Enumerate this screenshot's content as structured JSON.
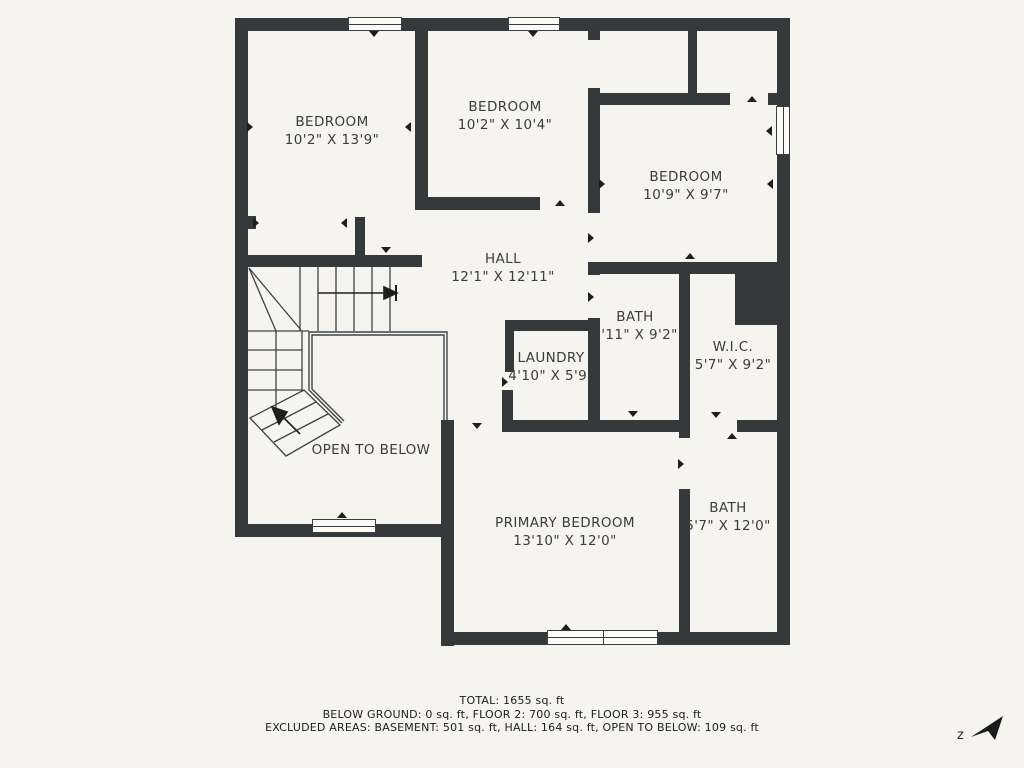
{
  "floorplan": {
    "colors": {
      "background": "#f5f4ee",
      "wall": "#35393c",
      "ink": "#1e1e1e",
      "line": "#3f4346",
      "text": "#3c3c3c"
    },
    "rooms": [
      {
        "id": "bedroom-1",
        "name": "BEDROOM",
        "dims": "10'2\" X 13'9\"",
        "cx": 332,
        "cy": 113
      },
      {
        "id": "bedroom-2",
        "name": "BEDROOM",
        "dims": "10'2\" X 10'4\"",
        "cx": 505,
        "cy": 98
      },
      {
        "id": "bedroom-3",
        "name": "BEDROOM",
        "dims": "10'9\" X 9'7\"",
        "cx": 686,
        "cy": 168
      },
      {
        "id": "hall",
        "name": "HALL",
        "dims": "12'1\" X 12'11\"",
        "cx": 503,
        "cy": 250
      },
      {
        "id": "bath-upper",
        "name": "BATH",
        "dims": "4'11\" X 9'2\"",
        "cx": 635,
        "cy": 308
      },
      {
        "id": "laundry",
        "name": "LAUNDRY",
        "dims": "4'10\" X 5'9\"",
        "cx": 551,
        "cy": 349
      },
      {
        "id": "wic",
        "name": "W.I.C.",
        "dims": "5'7\" X 9'2\"",
        "cx": 733,
        "cy": 338
      },
      {
        "id": "primary-bedroom",
        "name": "PRIMARY BEDROOM",
        "dims": "13'10\" X 12'0\"",
        "cx": 565,
        "cy": 514
      },
      {
        "id": "bath-primary",
        "name": "BATH",
        "dims": "5'7\" X 12'0\"",
        "cx": 728,
        "cy": 499
      },
      {
        "id": "open-to-below",
        "name": "OPEN TO BELOW",
        "dims": "",
        "cx": 371,
        "cy": 441
      }
    ],
    "walls": [
      [
        235,
        18,
        555,
        13
      ],
      [
        235,
        18,
        13,
        519
      ],
      [
        235,
        524,
        219,
        13
      ],
      [
        441,
        420,
        13,
        226
      ],
      [
        441,
        632,
        349,
        13
      ],
      [
        777,
        18,
        13,
        627
      ],
      [
        415,
        18,
        13,
        192
      ],
      [
        415,
        197,
        125,
        13
      ],
      [
        238,
        255,
        184,
        12
      ],
      [
        246,
        216,
        10,
        13
      ],
      [
        355,
        217,
        10,
        45
      ],
      [
        588,
        25,
        12,
        15
      ],
      [
        588,
        88,
        12,
        125
      ],
      [
        588,
        262,
        12,
        13
      ],
      [
        588,
        318,
        12,
        113
      ],
      [
        688,
        31,
        9,
        66
      ],
      [
        597,
        93,
        133,
        12
      ],
      [
        768,
        93,
        15,
        12
      ],
      [
        590,
        262,
        193,
        12
      ],
      [
        505,
        320,
        95,
        11
      ],
      [
        505,
        320,
        9,
        52
      ],
      [
        502,
        390,
        11,
        42
      ],
      [
        503,
        420,
        187,
        12
      ],
      [
        737,
        420,
        46,
        12
      ],
      [
        679,
        262,
        11,
        176
      ],
      [
        679,
        489,
        11,
        143
      ],
      [
        735,
        270,
        48,
        55
      ]
    ],
    "windows": [
      [
        348,
        17,
        54,
        14,
        "h"
      ],
      [
        508,
        17,
        52,
        14,
        "h"
      ],
      [
        776,
        106,
        14,
        49,
        "v"
      ],
      [
        312,
        519,
        64,
        14,
        "h"
      ],
      [
        547,
        630,
        57,
        15,
        "h"
      ],
      [
        603,
        630,
        55,
        15,
        "h"
      ]
    ],
    "markers": [
      [
        374,
        35,
        "down"
      ],
      [
        533,
        35,
        "down"
      ],
      [
        258,
        222,
        "right"
      ],
      [
        346,
        222,
        "left"
      ],
      [
        386,
        251,
        "down"
      ],
      [
        560,
        204,
        "up"
      ],
      [
        593,
        237,
        "right"
      ],
      [
        593,
        296,
        "right"
      ],
      [
        507,
        381,
        "right"
      ],
      [
        477,
        427,
        "down"
      ],
      [
        683,
        463,
        "right"
      ],
      [
        716,
        416,
        "down"
      ],
      [
        732,
        437,
        "up"
      ],
      [
        752,
        100,
        "up"
      ],
      [
        771,
        130,
        "left"
      ],
      [
        342,
        516,
        "up"
      ],
      [
        566,
        628,
        "up"
      ],
      [
        252,
        126,
        "right"
      ],
      [
        410,
        126,
        "left"
      ],
      [
        604,
        183,
        "right"
      ],
      [
        772,
        183,
        "left"
      ],
      [
        690,
        257,
        "up"
      ],
      [
        633,
        415,
        "down"
      ]
    ],
    "footer": {
      "total": "TOTAL: 1655 sq. ft",
      "floors": "BELOW GROUND: 0 sq. ft, FLOOR 2: 700 sq. ft, FLOOR 3: 955 sq. ft",
      "excluded": "EXCLUDED AREAS: BASEMENT: 501 sq. ft, HALL: 164 sq. ft, OPEN TO BELOW: 109 sq. ft"
    },
    "compass_letter": "z"
  }
}
